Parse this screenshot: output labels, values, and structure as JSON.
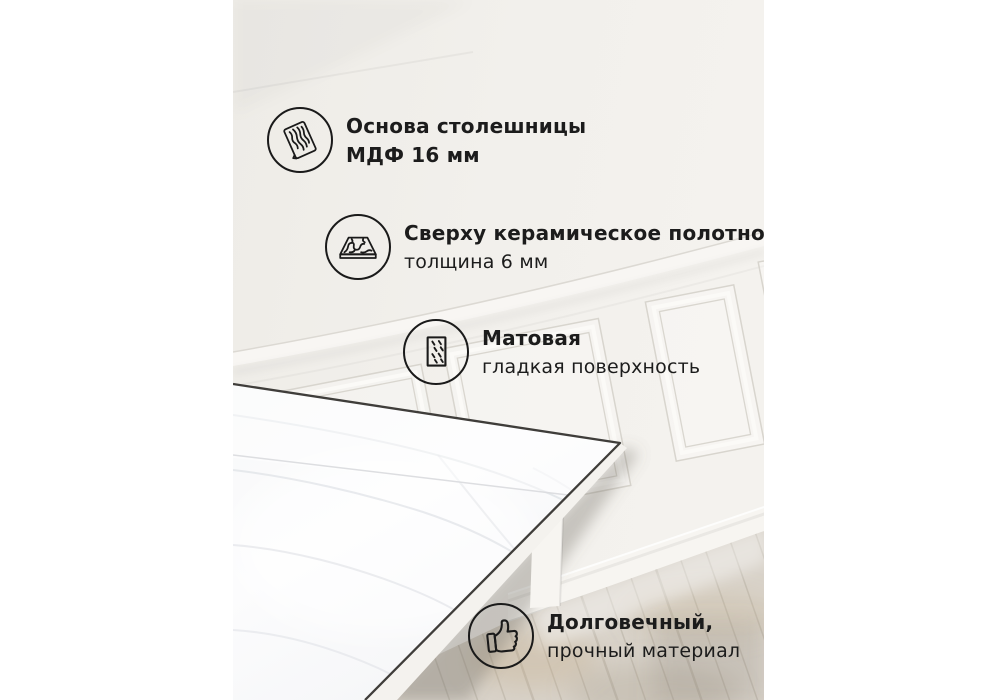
{
  "page": {
    "language": "ru",
    "kind": "product-feature-infographic"
  },
  "callouts": [
    {
      "icon": "wood-grain-icon",
      "title": "Основа столешницы",
      "subtitle": "МДФ 16 мм"
    },
    {
      "icon": "ceramic-slab-icon",
      "title": "Сверху керамическое полотно",
      "subtitle": "толщина 6 мм"
    },
    {
      "icon": "matte-surface-icon",
      "title": "Матовая",
      "subtitle": "гладкая поверхность"
    },
    {
      "icon": "thumb-up-icon",
      "title": "Долговечный,",
      "subtitle": "прочный материал"
    }
  ],
  "colors": {
    "margin": "#ffffff",
    "text": "#1c1c1c",
    "icon_stroke": "#1a1a1a",
    "wall": "#f1efeb",
    "molding_highlight": "#fbfaf7",
    "molding_shadow": "#d9d6cf",
    "marble": "#fafafb",
    "marble_vein": "#d4d8de",
    "table_edge_line": "#3f3d3a",
    "floor": "#d8d2c9",
    "floor_plank_line": "#bfb8ac"
  }
}
